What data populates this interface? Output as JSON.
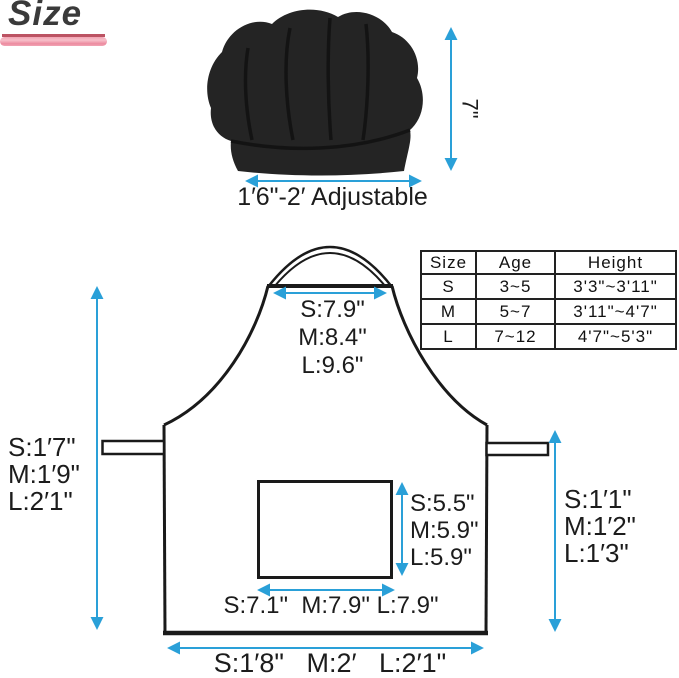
{
  "title": "Size",
  "hat": {
    "height_label": "7\"",
    "adjustable_label": "1′6\"-2′ Adjustable"
  },
  "size_table": {
    "col_size": "Size",
    "col_age": "Age",
    "col_height": "Height",
    "rows": [
      {
        "size": "S",
        "age": "3~5",
        "height": "3'3\"~3'11\""
      },
      {
        "size": "M",
        "age": "5~7",
        "height": "3'11\"~4'7\""
      },
      {
        "size": "L",
        "age": "7~12",
        "height": "4'7\"~5'3\""
      }
    ]
  },
  "apron": {
    "top_width": [
      "S:7.9\"",
      "M:8.4\"",
      "L:9.6\""
    ],
    "left_length": [
      "S:1′7\"",
      "M:1′9\"",
      "L:2′1\""
    ],
    "right_length": [
      "S:1′1\"",
      "M:1′2\"",
      "L:1′3\""
    ],
    "pocket_height": [
      "S:5.5\"",
      "M:5.9\"",
      "L:5.9\""
    ],
    "pocket_width": "S:7.1\"  M:7.9\" L:7.9\"",
    "bottom_width": "S:1′8\"   M:2′   L:2′1\""
  },
  "colors": {
    "arrow_blue": "#2aa0d8",
    "outline_black": "#1a1a1a",
    "hat_black": "#242424",
    "bar_pink": "#ef93a8",
    "bar_red": "#bc5363"
  }
}
